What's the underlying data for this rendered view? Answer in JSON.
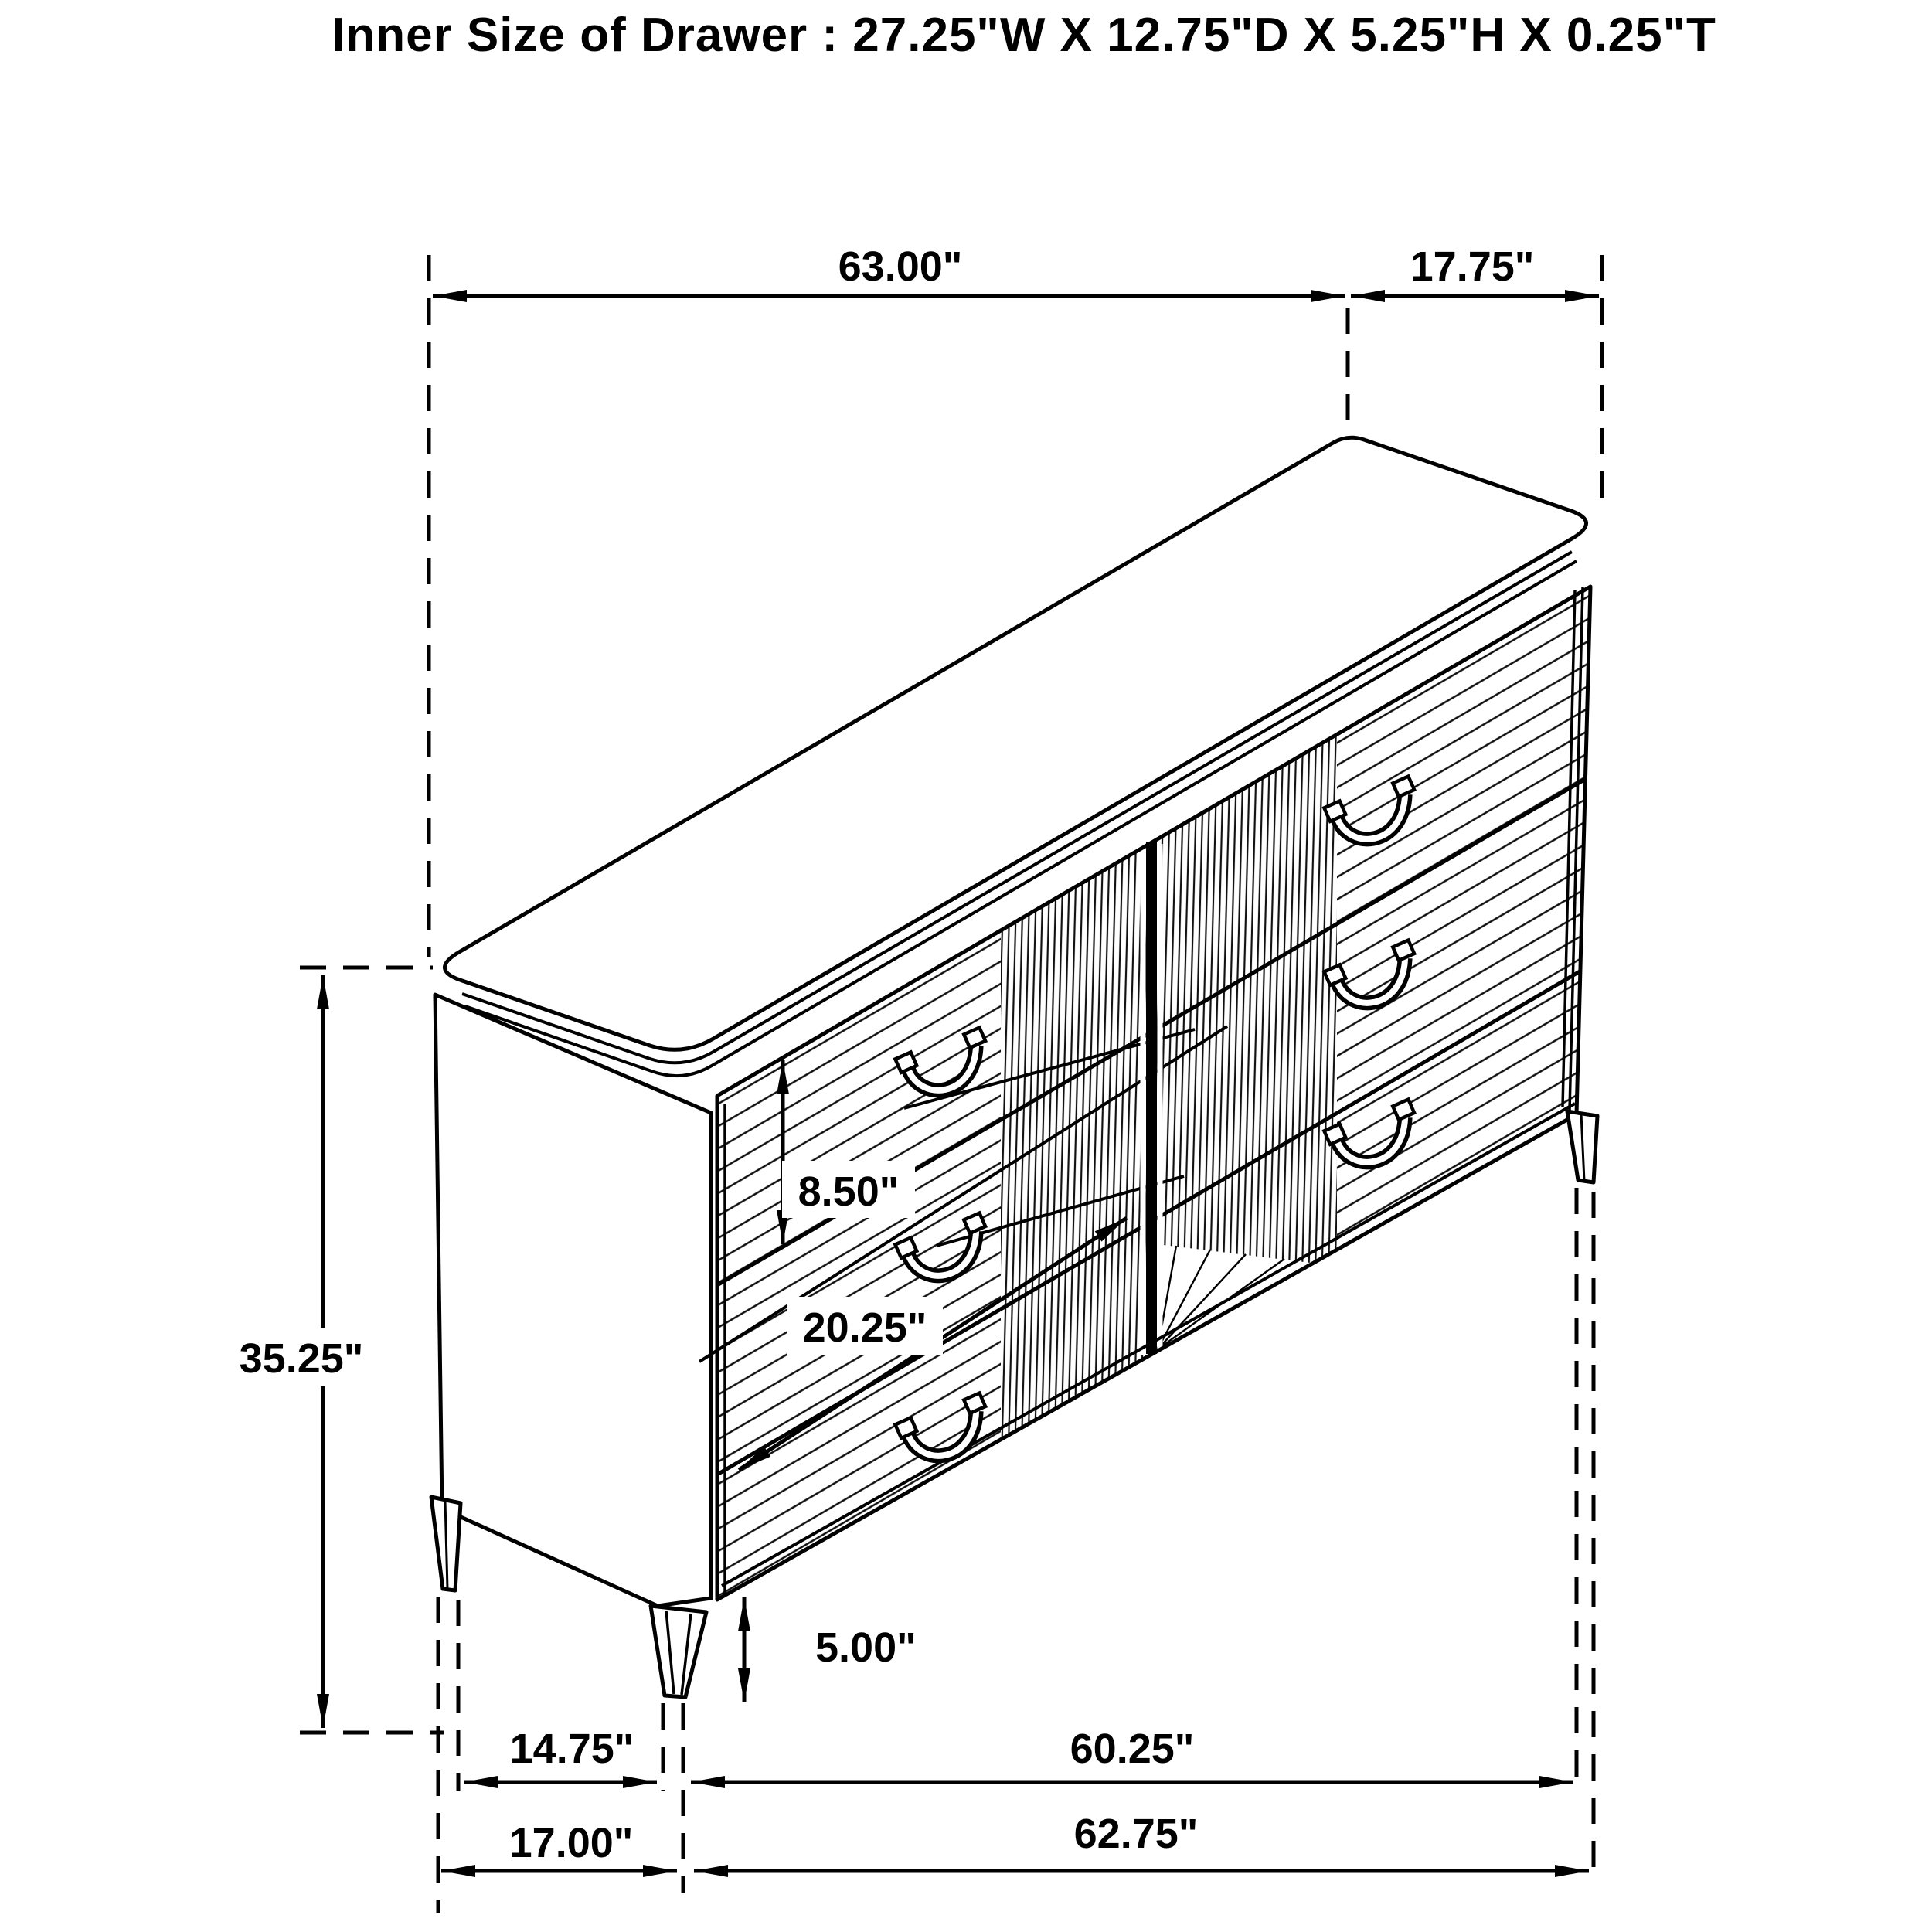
{
  "title": "Inner Size of Drawer : 27.25\"W X 12.75\"D X 5.25\"H X 0.25\"T",
  "dimensions": {
    "top_width": "63.00\"",
    "top_depth": "17.75\"",
    "overall_height": "35.25\"",
    "drawer_front_height": "8.50\"",
    "drawer_diagonal_width": "20.25\"",
    "leg_height": "5.00\"",
    "front_leg_inset_depth": "14.75\"",
    "leg_span_width": "60.25\"",
    "base_depth": "17.00\"",
    "base_width": "62.75\""
  },
  "drawing": {
    "line_color": "#000000",
    "background": "#ffffff"
  }
}
